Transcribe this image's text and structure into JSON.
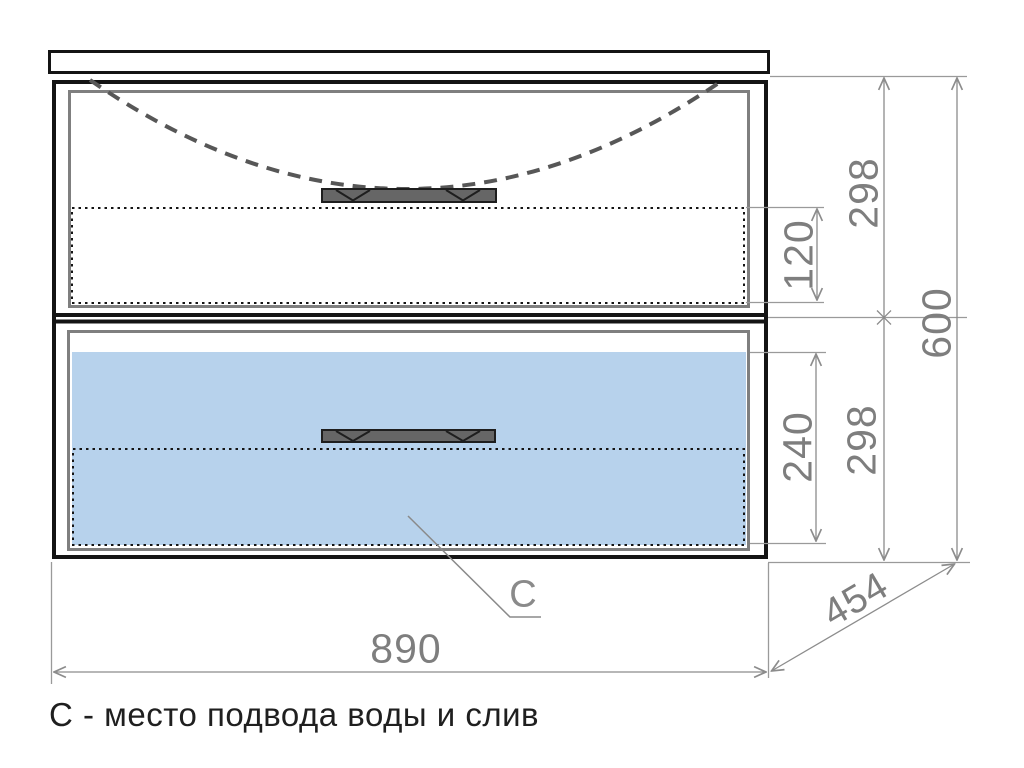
{
  "drawing": {
    "caption": "С - место подвода воды и слив",
    "connection_point_label": "С",
    "dimensions": {
      "overall_width": "890",
      "overall_depth": "454",
      "overall_height": "600",
      "top_drawer_front_height": "298",
      "top_drawer_inner_height": "120",
      "bottom_drawer_front_height": "298",
      "bottom_drawer_inner_height": "240"
    },
    "colors": {
      "bottom_drawer_interior_fill": "#b7d2ec",
      "handle_fill": "#666666",
      "outline_black": "#141414",
      "panel_gray": "#7f7f7f",
      "dimension_gray": "#8c8c8c",
      "dimension_text_gray": "#7e7e7e",
      "caption_black": "#1f1f1f"
    }
  }
}
